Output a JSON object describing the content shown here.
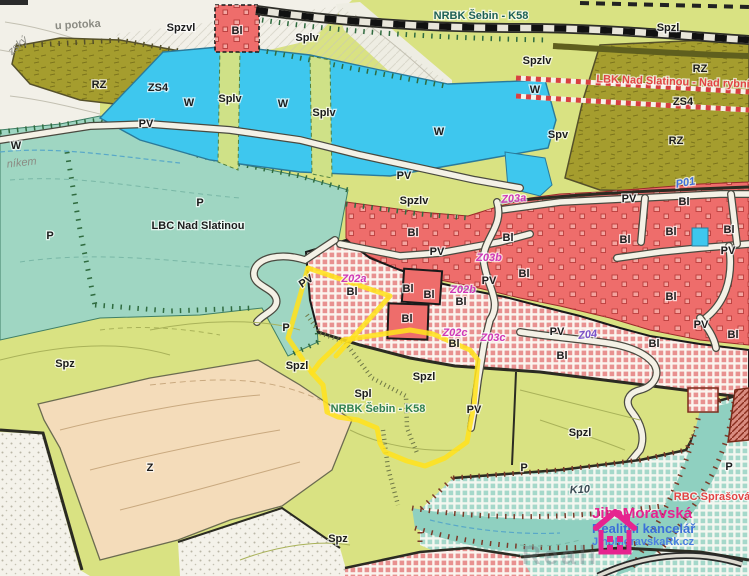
{
  "map": {
    "type": "zoning-plan-map",
    "colors": {
      "water": "#3ec7ee",
      "residential_red": "#ee6d6b",
      "reserve_olive": "#a59d2e",
      "nature_teal": "#9fd6c2",
      "agriculture_green": "#d9e282",
      "orchard_beige": "#f4dcba",
      "highlight_yellow": "#ffe11e",
      "proposed_hatch_red": "#e89190",
      "label_magenta": "#cf3ab8",
      "corridor_red_text": "#e24444",
      "watermark_pink": "#e6238f",
      "watermark_blue": "#3a6fd8"
    },
    "labels": [
      {
        "t": "u potoka",
        "x": 78,
        "y": 28,
        "c": "gray",
        "fs": 27,
        "rot": -3
      },
      {
        "t": "zský",
        "x": 20,
        "y": 48,
        "c": "grayi",
        "fs": 10,
        "rot": -42
      },
      {
        "t": "Spzvl",
        "x": 181,
        "y": 31,
        "c": "z"
      },
      {
        "t": "Bl",
        "x": 237,
        "y": 34,
        "c": "z"
      },
      {
        "t": "Splv",
        "x": 307,
        "y": 41,
        "c": "z"
      },
      {
        "t": "NRBK Šebin - K58",
        "x": 481,
        "y": 19,
        "c": "t"
      },
      {
        "t": "Spzl",
        "x": 668,
        "y": 31,
        "c": "z"
      },
      {
        "t": "RZ",
        "x": 99,
        "y": 88,
        "c": "z"
      },
      {
        "t": "ZS4",
        "x": 158,
        "y": 91,
        "c": "z",
        "fs": 10
      },
      {
        "t": "W",
        "x": 189,
        "y": 106,
        "c": "z"
      },
      {
        "t": "Splv",
        "x": 230,
        "y": 102,
        "c": "z",
        "fs": 10
      },
      {
        "t": "W",
        "x": 283,
        "y": 107,
        "c": "z"
      },
      {
        "t": "Splv",
        "x": 324,
        "y": 116,
        "c": "z",
        "fs": 10
      },
      {
        "t": "W",
        "x": 439,
        "y": 135,
        "c": "z"
      },
      {
        "t": "Spzlv",
        "x": 537,
        "y": 64,
        "c": "z",
        "fs": 10
      },
      {
        "t": "W",
        "x": 535,
        "y": 93,
        "c": "z",
        "fs": 10
      },
      {
        "t": "RZ",
        "x": 700,
        "y": 72,
        "c": "z"
      },
      {
        "t": "LBK Nad Slatinou - Nad rybník",
        "x": 676,
        "y": 85,
        "c": "r",
        "fs": 10,
        "rot": 2
      },
      {
        "t": "ZS4",
        "x": 683,
        "y": 105,
        "c": "z",
        "fs": 10
      },
      {
        "t": "Spv",
        "x": 558,
        "y": 138,
        "c": "z"
      },
      {
        "t": "RZ",
        "x": 676,
        "y": 144,
        "c": "z"
      },
      {
        "t": "PV",
        "x": 146,
        "y": 127,
        "c": "z",
        "fs": 10
      },
      {
        "t": "PV",
        "x": 404,
        "y": 179,
        "c": "z",
        "fs": 10
      },
      {
        "t": "W",
        "x": 16,
        "y": 149,
        "c": "z",
        "fs": 9
      },
      {
        "t": "níkem",
        "x": 22,
        "y": 166,
        "c": "grayi",
        "fs": 10,
        "rot": -6
      },
      {
        "t": "P",
        "x": 50,
        "y": 239,
        "c": "z"
      },
      {
        "t": "P",
        "x": 200,
        "y": 206,
        "c": "z"
      },
      {
        "t": "LBC Nad Slatinou",
        "x": 198,
        "y": 229,
        "c": "z",
        "fs": 12
      },
      {
        "t": "Spzlv",
        "x": 414,
        "y": 204,
        "c": "z",
        "fs": 10
      },
      {
        "t": "Z03a",
        "x": 514,
        "y": 202,
        "c": "m",
        "rot": -4
      },
      {
        "t": "P01",
        "x": 686,
        "y": 186,
        "c": "b",
        "rot": -10
      },
      {
        "t": "PV",
        "x": 308,
        "y": 284,
        "c": "z",
        "fs": 10,
        "rot": -34
      },
      {
        "t": "Bl",
        "x": 413,
        "y": 236,
        "c": "z"
      },
      {
        "t": "PV",
        "x": 437,
        "y": 255,
        "c": "z",
        "fs": 10
      },
      {
        "t": "Bl",
        "x": 508,
        "y": 241,
        "c": "z"
      },
      {
        "t": "Z03b",
        "x": 489,
        "y": 261,
        "c": "m"
      },
      {
        "t": "PV",
        "x": 489,
        "y": 284,
        "c": "z",
        "fs": 10
      },
      {
        "t": "Z02a",
        "x": 354,
        "y": 282,
        "c": "m"
      },
      {
        "t": "Bl",
        "x": 352,
        "y": 295,
        "c": "z",
        "fs": 10
      },
      {
        "t": "Bl",
        "x": 408,
        "y": 292,
        "c": "z",
        "fs": 10
      },
      {
        "t": "Bl",
        "x": 429,
        "y": 298,
        "c": "z",
        "fs": 10
      },
      {
        "t": "Z02b",
        "x": 463,
        "y": 293,
        "c": "m"
      },
      {
        "t": "Bl",
        "x": 461,
        "y": 305,
        "c": "z",
        "fs": 10
      },
      {
        "t": "Bl",
        "x": 407,
        "y": 322,
        "c": "z"
      },
      {
        "t": "Z02c",
        "x": 455,
        "y": 336,
        "c": "m"
      },
      {
        "t": "Bl",
        "x": 454,
        "y": 347,
        "c": "z",
        "fs": 10
      },
      {
        "t": "Z03c",
        "x": 493,
        "y": 341,
        "c": "m"
      },
      {
        "t": "P",
        "x": 286,
        "y": 331,
        "c": "z"
      },
      {
        "t": "Bl",
        "x": 684,
        "y": 205,
        "c": "z"
      },
      {
        "t": "PV",
        "x": 629,
        "y": 202,
        "c": "z",
        "fs": 10
      },
      {
        "t": "Bl",
        "x": 625,
        "y": 243,
        "c": "z"
      },
      {
        "t": "Bl",
        "x": 671,
        "y": 235,
        "c": "z",
        "fs": 10
      },
      {
        "t": "Bl",
        "x": 729,
        "y": 233,
        "c": "z",
        "fs": 10
      },
      {
        "t": "PV",
        "x": 728,
        "y": 254,
        "c": "z",
        "fs": 10
      },
      {
        "t": "Bl",
        "x": 524,
        "y": 277,
        "c": "z"
      },
      {
        "t": "Bl",
        "x": 671,
        "y": 300,
        "c": "z"
      },
      {
        "t": "PV",
        "x": 557,
        "y": 335,
        "c": "z",
        "fs": 10
      },
      {
        "t": "Z04",
        "x": 588,
        "y": 338,
        "c": "v",
        "rot": -6
      },
      {
        "t": "Bl",
        "x": 654,
        "y": 347,
        "c": "z"
      },
      {
        "t": "Bl",
        "x": 562,
        "y": 359,
        "c": "z"
      },
      {
        "t": "PV",
        "x": 701,
        "y": 328,
        "c": "z",
        "fs": 10
      },
      {
        "t": "Bl",
        "x": 733,
        "y": 338,
        "c": "z",
        "fs": 10
      },
      {
        "t": "Spzl",
        "x": 297,
        "y": 369,
        "c": "z"
      },
      {
        "t": "Spzl",
        "x": 424,
        "y": 380,
        "c": "z"
      },
      {
        "t": "Spl",
        "x": 363,
        "y": 397,
        "c": "z"
      },
      {
        "t": "NRBK Šebin - K58",
        "x": 378,
        "y": 412,
        "c": "g"
      },
      {
        "t": "PV",
        "x": 474,
        "y": 413,
        "c": "z",
        "fs": 10
      },
      {
        "t": "Spz",
        "x": 65,
        "y": 367,
        "c": "z"
      },
      {
        "t": "Z",
        "x": 150,
        "y": 471,
        "c": "z"
      },
      {
        "t": "Spz",
        "x": 338,
        "y": 542,
        "c": "z"
      },
      {
        "t": "Spzl",
        "x": 580,
        "y": 436,
        "c": "z"
      },
      {
        "t": "P",
        "x": 524,
        "y": 471,
        "c": "z",
        "fs": 10
      },
      {
        "t": "K10",
        "x": 580,
        "y": 493,
        "c": "k",
        "rot": -3
      },
      {
        "t": "P",
        "x": 729,
        "y": 470,
        "c": "z"
      },
      {
        "t": "RBC Sprašová",
        "x": 712,
        "y": 500,
        "c": "r"
      }
    ],
    "watermark": {
      "line1": "JihoMoravská",
      "line2": "Realitní kancelář",
      "line3": "JihoMoravskaRk.cz",
      "ghost": "Reali"
    }
  }
}
